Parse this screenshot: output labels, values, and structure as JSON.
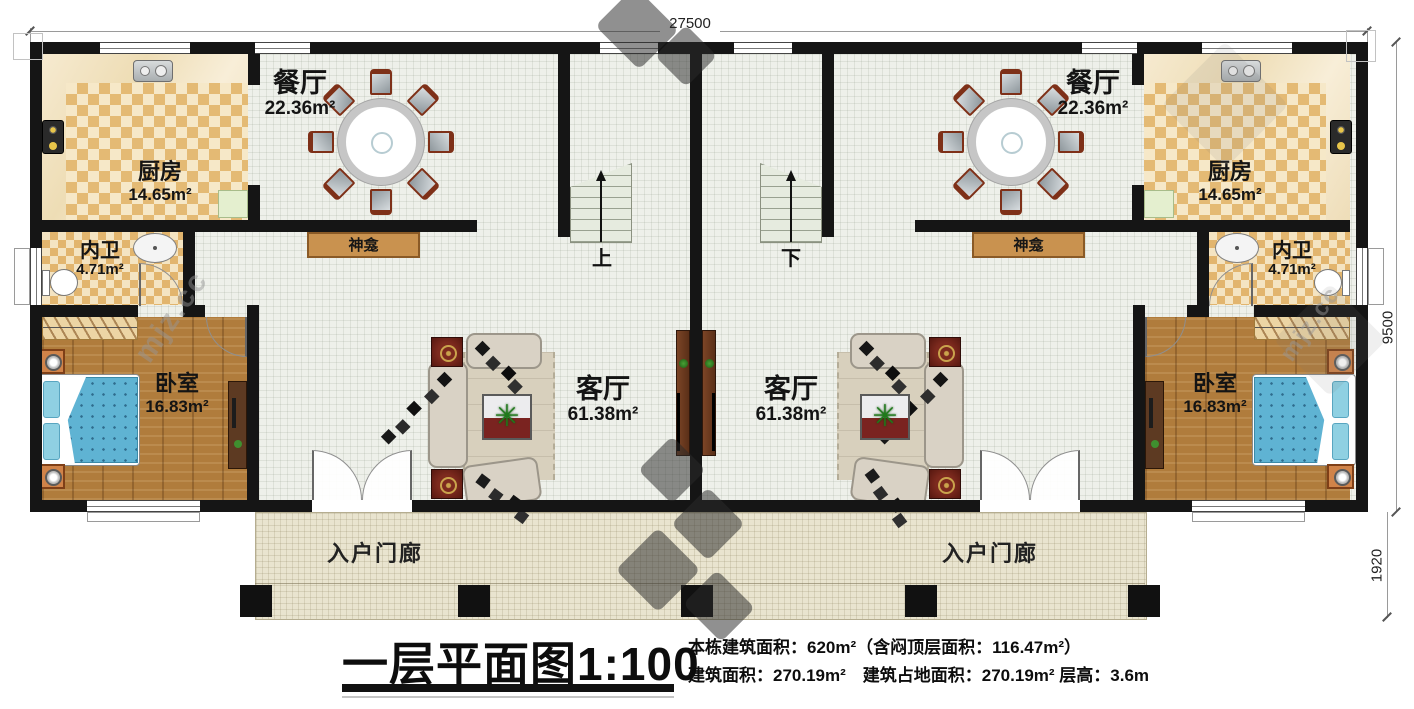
{
  "plan": {
    "dimensions": {
      "top_width": "27500",
      "right_height": "9500",
      "porch_height": "1920"
    },
    "rooms": {
      "dining": {
        "name": "餐厅",
        "area": "22.36m²"
      },
      "kitchen": {
        "name": "厨房",
        "area": "14.65m²"
      },
      "bath": {
        "name": "内卫",
        "area": "4.71m²"
      },
      "bedroom": {
        "name": "卧室",
        "area": "16.83m²"
      },
      "living": {
        "name": "客厅",
        "area": "61.38m²"
      }
    },
    "features": {
      "shrine": "神龛",
      "porch": "入户门廊",
      "stairs_up": "上",
      "stairs_down": "下"
    },
    "watermark": "mjz.cc"
  },
  "legend": {
    "title": "一层平面图1:100",
    "line1": "本栋建筑面积：620m²（含闷顶层面积：116.47m²）",
    "line2": "建筑面积：270.19m²　建筑占地面积：270.19m² 层高：3.6m"
  },
  "colors": {
    "wall": "#151515",
    "kitchen_tile": "#e4ba74",
    "wood_floor": "#b07c3c",
    "bed_blue": "#5fb3d3",
    "shrine_wood": "#c9924f",
    "porch_floor": "#e9e4cf",
    "accent_red": "#6e2320"
  }
}
